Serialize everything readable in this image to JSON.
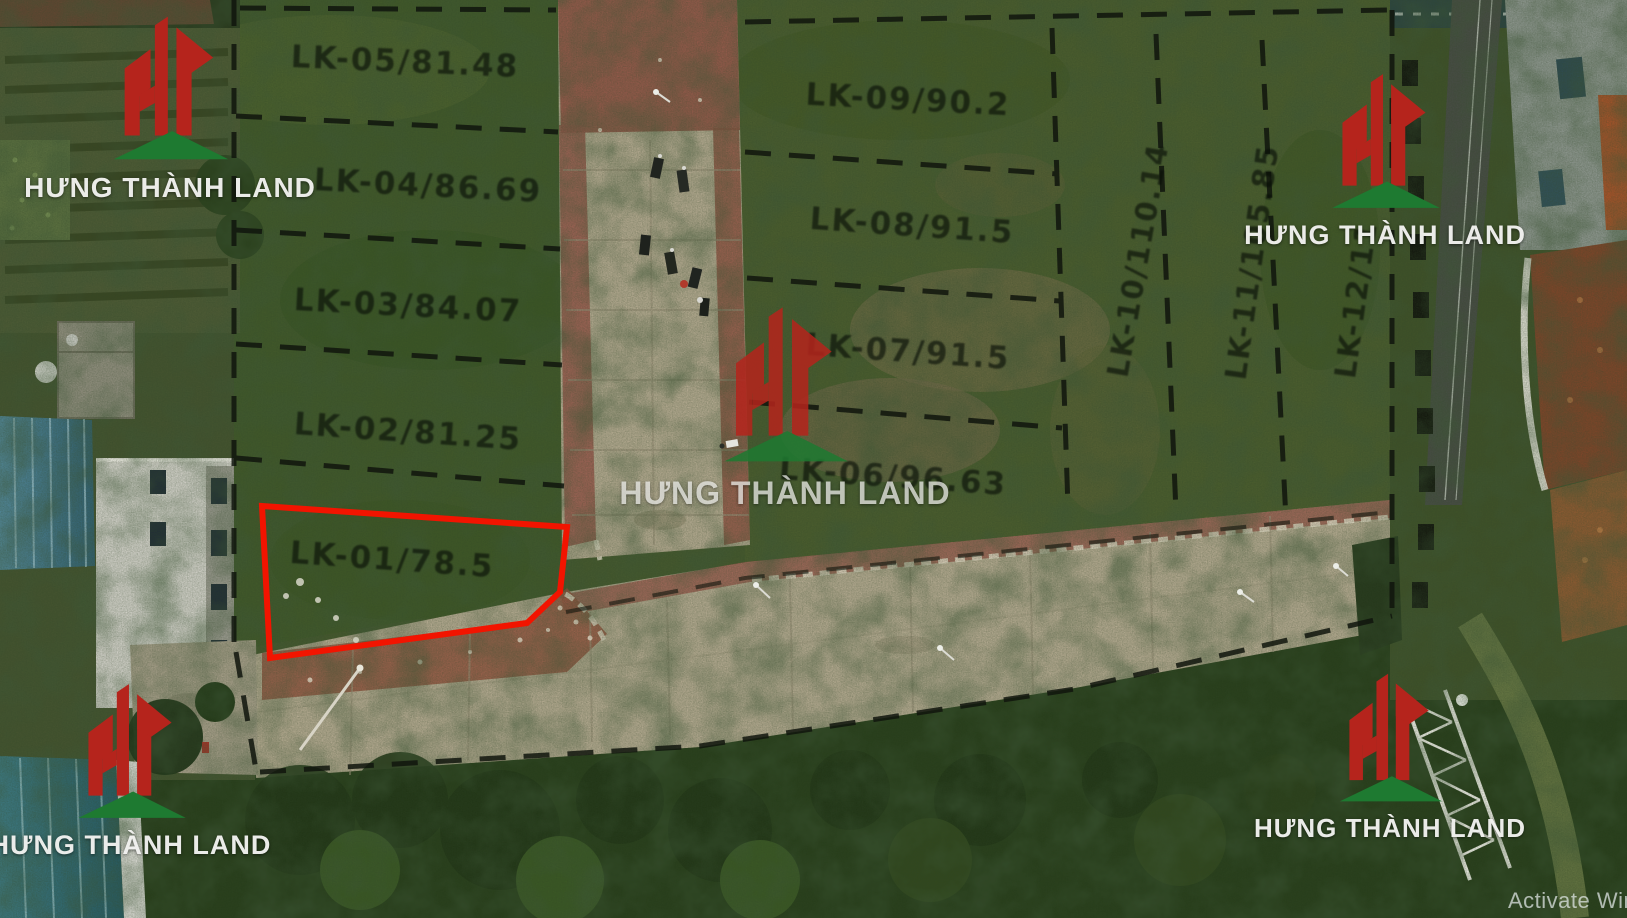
{
  "brand": {
    "name": "HƯNG THÀNH LAND",
    "logo_red": "#b5241c",
    "logo_green": "#1e7a31"
  },
  "plots": {
    "left_block": [
      {
        "id": "LK-05",
        "label": "LK-05/81.48"
      },
      {
        "id": "LK-04",
        "label": "LK-04/86.69"
      },
      {
        "id": "LK-03",
        "label": "LK-03/84.07"
      },
      {
        "id": "LK-02",
        "label": "LK-02/81.25"
      },
      {
        "id": "LK-01",
        "label": "LK-01/78.5",
        "highlighted": true,
        "highlight_color": "#f21400"
      }
    ],
    "right_block": [
      {
        "id": "LK-09",
        "label": "LK-09/90.2"
      },
      {
        "id": "LK-08",
        "label": "LK-08/91.5"
      },
      {
        "id": "LK-07",
        "label": "LK-07/91.5"
      },
      {
        "id": "LK-06",
        "label": "LK-06/96.63"
      }
    ],
    "vertical_strip": [
      {
        "id": "LK-10",
        "label": "LK-10/110.14"
      },
      {
        "id": "LK-11",
        "label": "LK-11/105.85"
      },
      {
        "id": "LK-12",
        "label": "LK-12/11"
      }
    ]
  },
  "overlay": {
    "activation_text": "Activate Wind",
    "boundary_color": "#10150d"
  }
}
